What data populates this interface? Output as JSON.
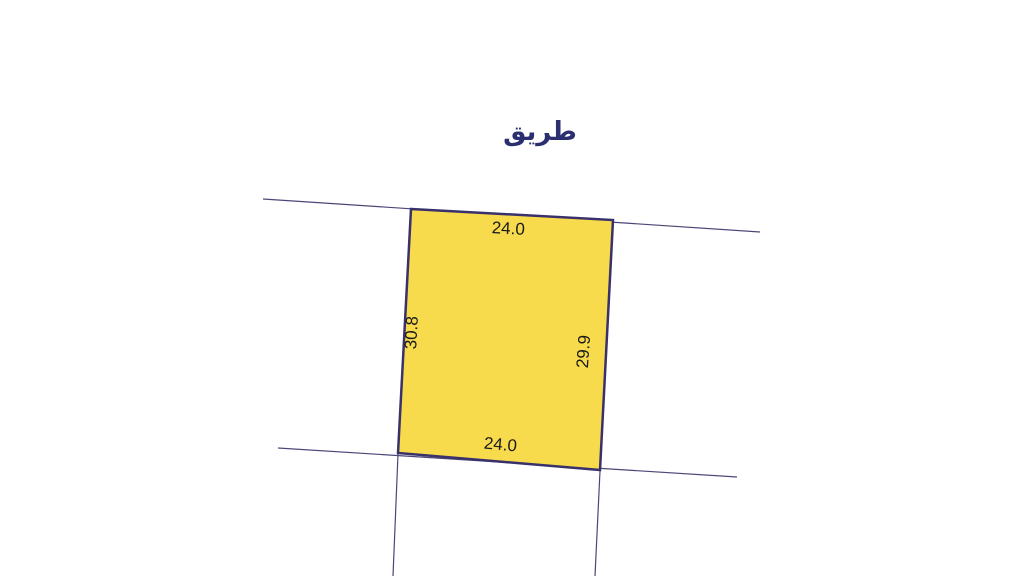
{
  "road": {
    "label": "طريق"
  },
  "parcel": {
    "dimensions": {
      "top": "24.0",
      "bottom": "24.0",
      "left": "30.8",
      "right": "29.9"
    },
    "fill": "#F7DB4D",
    "stroke": "#39316B"
  },
  "colors": {
    "background": "#FFFFFF",
    "road_line": "#4B4677",
    "dimension_text": "#1A1A1A",
    "road_label": "#2B2F6F"
  }
}
